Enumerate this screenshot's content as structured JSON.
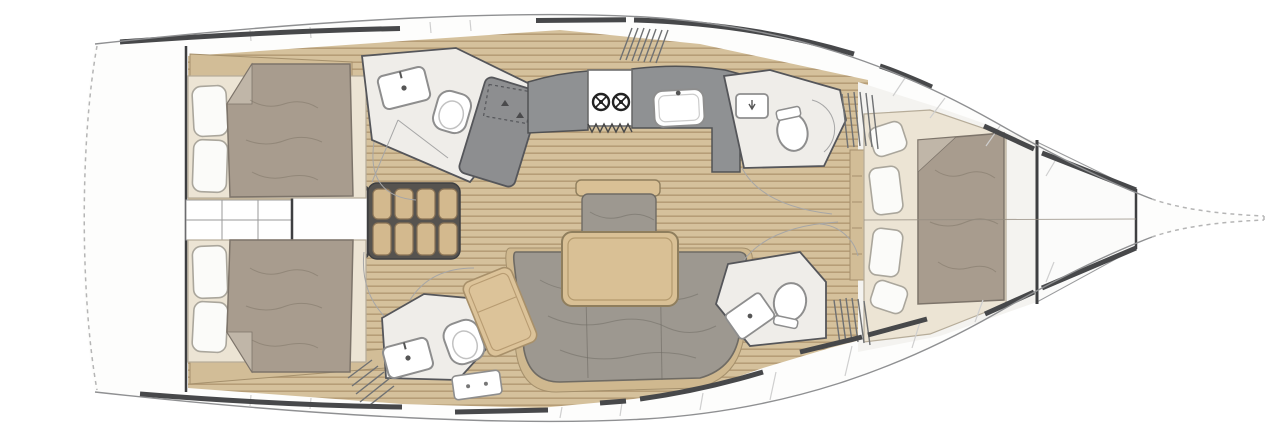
{
  "diagram": {
    "type": "yacht-interior-floorplan",
    "orientation": "bow-right",
    "rooms": [
      "aft-cabin-top",
      "aft-cabin-bottom",
      "aft-head-top",
      "aft-head-bottom",
      "companionway",
      "galley",
      "salon",
      "forward-head-top",
      "forward-head-bottom",
      "forward-cabin",
      "anchor-locker",
      "bow"
    ],
    "fixtures": [
      "double-bed",
      "pillows",
      "two-burner-stove",
      "galley-sink",
      "toilet",
      "washbasin",
      "shower-panel",
      "shower-tray",
      "salon-table",
      "u-settee",
      "bench-seat",
      "chaise-longue",
      "companionway-steps",
      "hanging-locker-louvers",
      "engine-box",
      "deck-seams",
      "bow-dashed-outline",
      "transom-dashed-outline"
    ]
  },
  "palette": {
    "paper": "#ffffff",
    "hullline": "#8f9092",
    "trunk": "#47484a",
    "interior": "#f4f3f0",
    "wood": "#d5c19c",
    "woodline": "#b69d77",
    "trim": "#d2bd97",
    "trimline": "#a5906c",
    "cream": "#ece4d4",
    "creamline": "#b6ac99",
    "pillow": "#fbfbf9",
    "pillowline": "#aaa69c",
    "duvet": "#a89c8e",
    "duvetline": "#7d746a",
    "duvetfold": "#c0b6a8",
    "sofa": "#9d9890",
    "sofaline": "#6f6b64",
    "sofaunder": "#cfb88f",
    "table": "#d9c095",
    "tableline": "#8f7e5d",
    "counter": "#8f9193",
    "counterline": "#515254",
    "fixture": "#ffffff",
    "fixtureline": "#8e8e8e",
    "headfloor": "#efede9",
    "headfloorline": "#55565a",
    "shower": "#8d8e90",
    "stepsbg": "#56534f",
    "steps": "#d3b98e",
    "stepsline": "#8a7355",
    "seam": "#cfcfcf",
    "dash": "#b5b5b5",
    "swing": "#a6a6a6",
    "dark": "#3e3f41"
  }
}
